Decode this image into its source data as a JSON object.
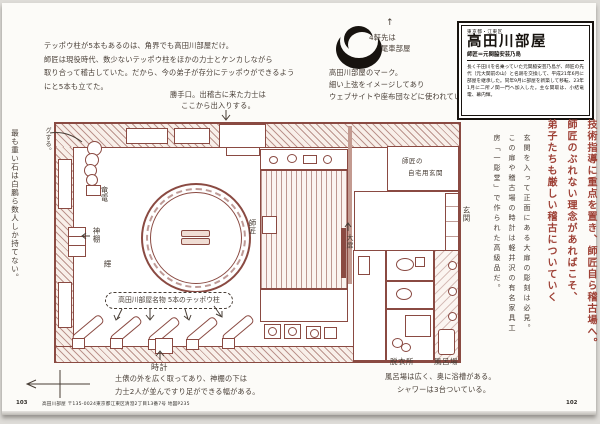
{
  "colors": {
    "plan_line": "#8a4a42",
    "handwriting_ink": "#473d35",
    "lead_red": "#9e4136",
    "black": "#17130f"
  },
  "intro_note": {
    "lines": [
      "テッポウ柱が5本もあるのは、角界でも高田川部屋だけ。",
      "師匠は現役時代、数少ないテッポウ柱をほかの力士とケンカしながら",
      "取り合って稽古していた。だから、今の弟子が存分にテッポウができるよう",
      "にと5本も立てた。"
    ]
  },
  "katteguchi_note": {
    "line1": "勝手口。出稽古に来た力士は",
    "line2": "ここから出入りする。"
  },
  "stone_note_outer": "最も重い石は白鵬ら数人しか持てない。",
  "stone_note_inner": "石の玉。上から100㌔、70㌔、50㌔。これを持ってトレーニングする。",
  "teppo_bubble": "高田川部屋名物 5本のテッポウ柱",
  "plan_labels": {
    "ryuden": "竜電",
    "kamidana": "神棚",
    "kagayaki": "輝",
    "shisho": "師匠",
    "obira": "大扉",
    "genkan": "玄関",
    "tokei": "時計",
    "datsuijo": "脱衣所",
    "furoba": "風呂場",
    "private_entrance_line1": "師匠の",
    "private_entrance_line2": "自宅用玄関"
  },
  "clock_note": {
    "line1": "土俵の外を広く取ってあり、神棚の下は",
    "line2": "力士2人が並んですり足ができる幅がある。"
  },
  "bath_note": {
    "line1": "風呂場は広く、奥に浴槽がある。",
    "line2": "シャワーは3台ついている。"
  },
  "logo": {
    "caption_lines": [
      "高田川部屋のマーク。",
      "細い上弦をイメージしてあり",
      "ウェブサイトや座布団などに使われている。"
    ],
    "neighbor_arrow": "↑",
    "neighbor_line1": "4軒先は",
    "neighbor_line2": "尾車部屋"
  },
  "info_box": {
    "region": "東京都・江東区",
    "title": "高田川部屋",
    "subtitle": "師匠＝元関脇安芸乃島",
    "body": "長く千田川を名乗っていた元関脇安芸乃島が、師匠の先代（元大関前の山）と名跡を交換して、平成21年6月に部屋を継承した。同年9月に部屋を新築して移転、23年1月に二所ノ関一門へ加入した。主な関取は、小結竜電、幕内輝。"
  },
  "lead_vertical": {
    "lines": [
      "技術指導に重点を置き、師匠自ら稽古場へ。",
      "師匠のぶれない理念があればこそ、",
      "弟子たちも厳しい稽古についていく"
    ]
  },
  "door_note": "玄関を入って正面にある大扉の彫刻は必見。この扉や稽古場の時計は軽井沢の有名家具工房「一彫堂」で作られた高級品だ。",
  "footer": {
    "left_page_number": "103",
    "right_page_number": "102",
    "address": "高田川部屋 〒135-0024東京都江東区清澄2丁目13番7号  地図P235"
  }
}
